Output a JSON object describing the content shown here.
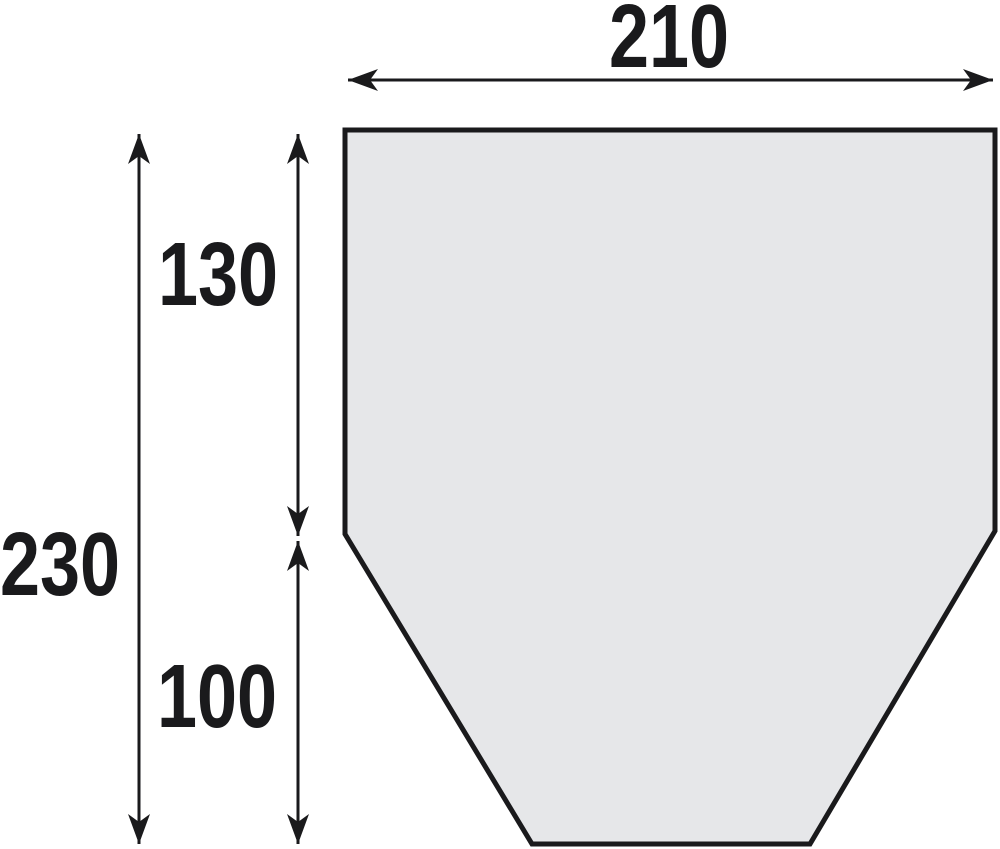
{
  "diagram": {
    "description": "Dimensioned outline drawing of a six-sided panel: rectangular top section tapering to a narrower flat bottom",
    "canvas": {
      "width": 1000,
      "height": 849,
      "background": "#ffffff"
    },
    "ink_color": "#1a1a1c",
    "shape": {
      "name": "tapered-panel-outline",
      "fill": "#e6e7e9",
      "stroke": "#1a1a1c",
      "stroke_width": 5,
      "points": "345,130 995,130 995,531 810,844 532,844 345,534"
    },
    "dim_line_width": 3,
    "arrowhead": {
      "length": 30,
      "half_width": 11,
      "notch": 22
    },
    "label_font_size": 90,
    "label_scale_x": 0.8,
    "dimensions": [
      {
        "id": "overall-width",
        "label": "210",
        "orientation": "h",
        "axis": 80,
        "from": 348,
        "to": 993,
        "label_x": 669,
        "label_y": 67
      },
      {
        "id": "overall-height",
        "label": "230",
        "orientation": "v",
        "axis": 139,
        "from": 134,
        "to": 844,
        "label_x": 60,
        "label_y": 595
      },
      {
        "id": "upper-height",
        "label": "130",
        "orientation": "v",
        "axis": 298,
        "from": 134,
        "to": 536,
        "label_x": 218,
        "label_y": 305
      },
      {
        "id": "lower-height",
        "label": "100",
        "orientation": "v",
        "axis": 298,
        "from": 541,
        "to": 844,
        "label_x": 217,
        "label_y": 727
      }
    ]
  }
}
